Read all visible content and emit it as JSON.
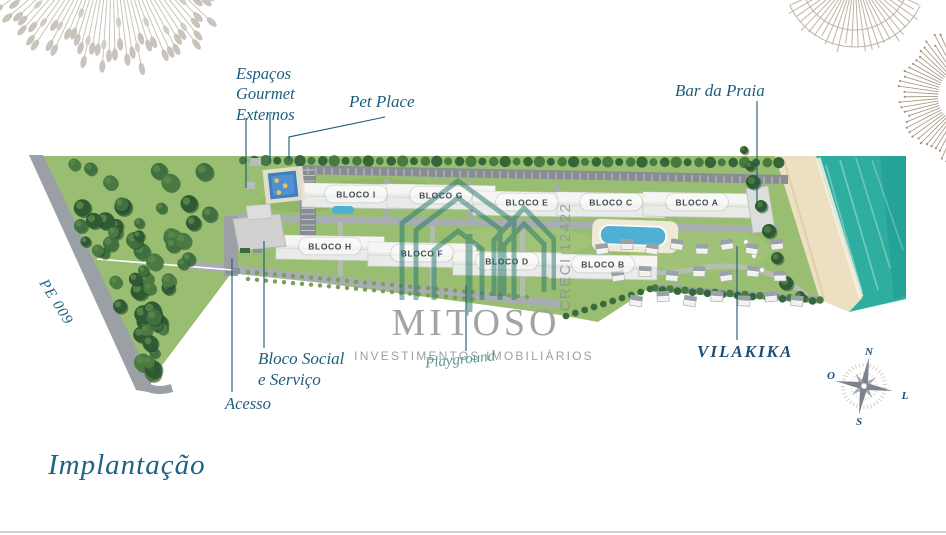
{
  "title": {
    "text": "Implantação"
  },
  "annotations": {
    "espacos_gourmet": {
      "lines": [
        "Espaços",
        "Gourmet",
        "Externos"
      ]
    },
    "pet_place": {
      "label": "Pet Place"
    },
    "bar_da_praia": {
      "label": "Bar da Praia"
    },
    "pe009": {
      "label": "PE 009"
    },
    "bloco_social": {
      "lines": [
        "Bloco Social",
        "e Serviço"
      ]
    },
    "acesso": {
      "label": "Acesso"
    },
    "vilakika": {
      "label": "VILAKIKA"
    },
    "playground": {
      "label": "Playground"
    }
  },
  "blocks": [
    {
      "label": "BLOCO I"
    },
    {
      "label": "BLOCO G"
    },
    {
      "label": "BLOCO E"
    },
    {
      "label": "BLOCO C"
    },
    {
      "label": "BLOCO A"
    },
    {
      "label": "BLOCO H"
    },
    {
      "label": "BLOCO F"
    },
    {
      "label": "BLOCO D"
    },
    {
      "label": "BLOCO B"
    }
  ],
  "watermark": {
    "brand": "MITOSO",
    "tagline": "INVESTIMENTOS IMOBILIÁRIOS",
    "creci": "CRECI 12422"
  },
  "compass": {
    "north": "N",
    "west": "O",
    "east": "L",
    "south": "S"
  },
  "colors": {
    "label_blue": "#1c5d7d",
    "navy": "#1d4e78",
    "logo_teal": "#26756c",
    "watermark_gray": "#9aa0a3",
    "water": "#2aa89e",
    "sand": "#e9d9b8",
    "grass": "#98bc70",
    "road": "#9aa0a6"
  }
}
